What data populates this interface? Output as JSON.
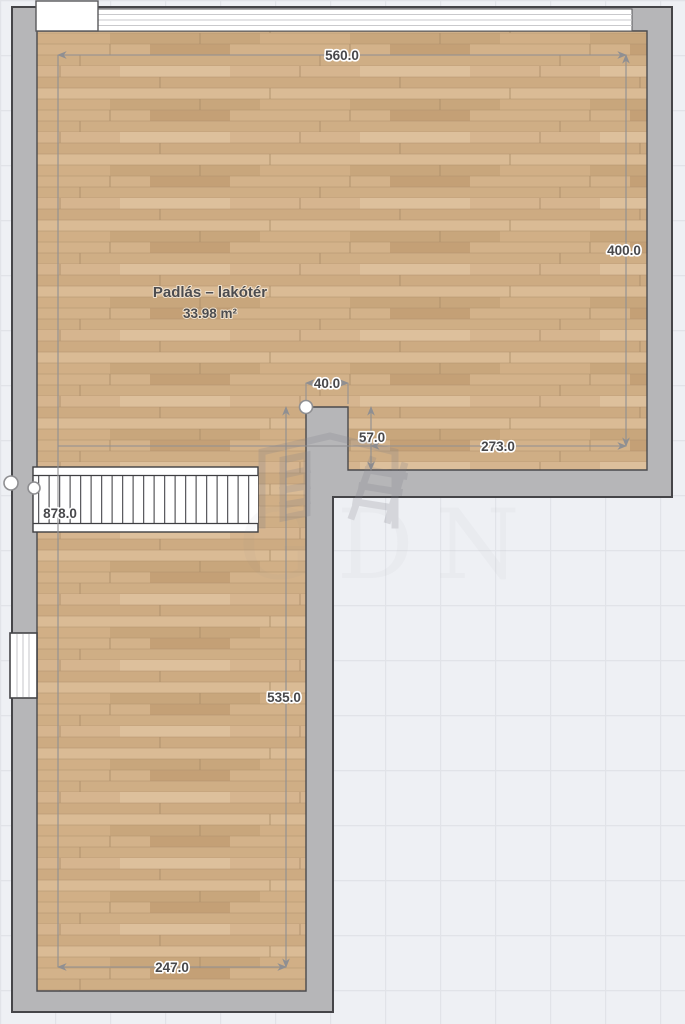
{
  "room": {
    "name": "Padlás – lakótér",
    "area": "33.98 m²"
  },
  "dim": {
    "top": "560.0",
    "right": "400.0",
    "inner_bottom_right": "273.0",
    "notch_width": "40.0",
    "notch_depth": "57.0",
    "stairs": "878.0",
    "lower_height": "535.0",
    "bottom": "247.0"
  },
  "watermark": {
    "text": "GDN"
  },
  "colors": {
    "wall_fill": "#b6b6b8",
    "outline": "#454548",
    "floor_base": "#d2b28b",
    "dimension_line": "#8f8f92",
    "background": "#eef0f4",
    "grid_line": "#e1e3e8"
  }
}
